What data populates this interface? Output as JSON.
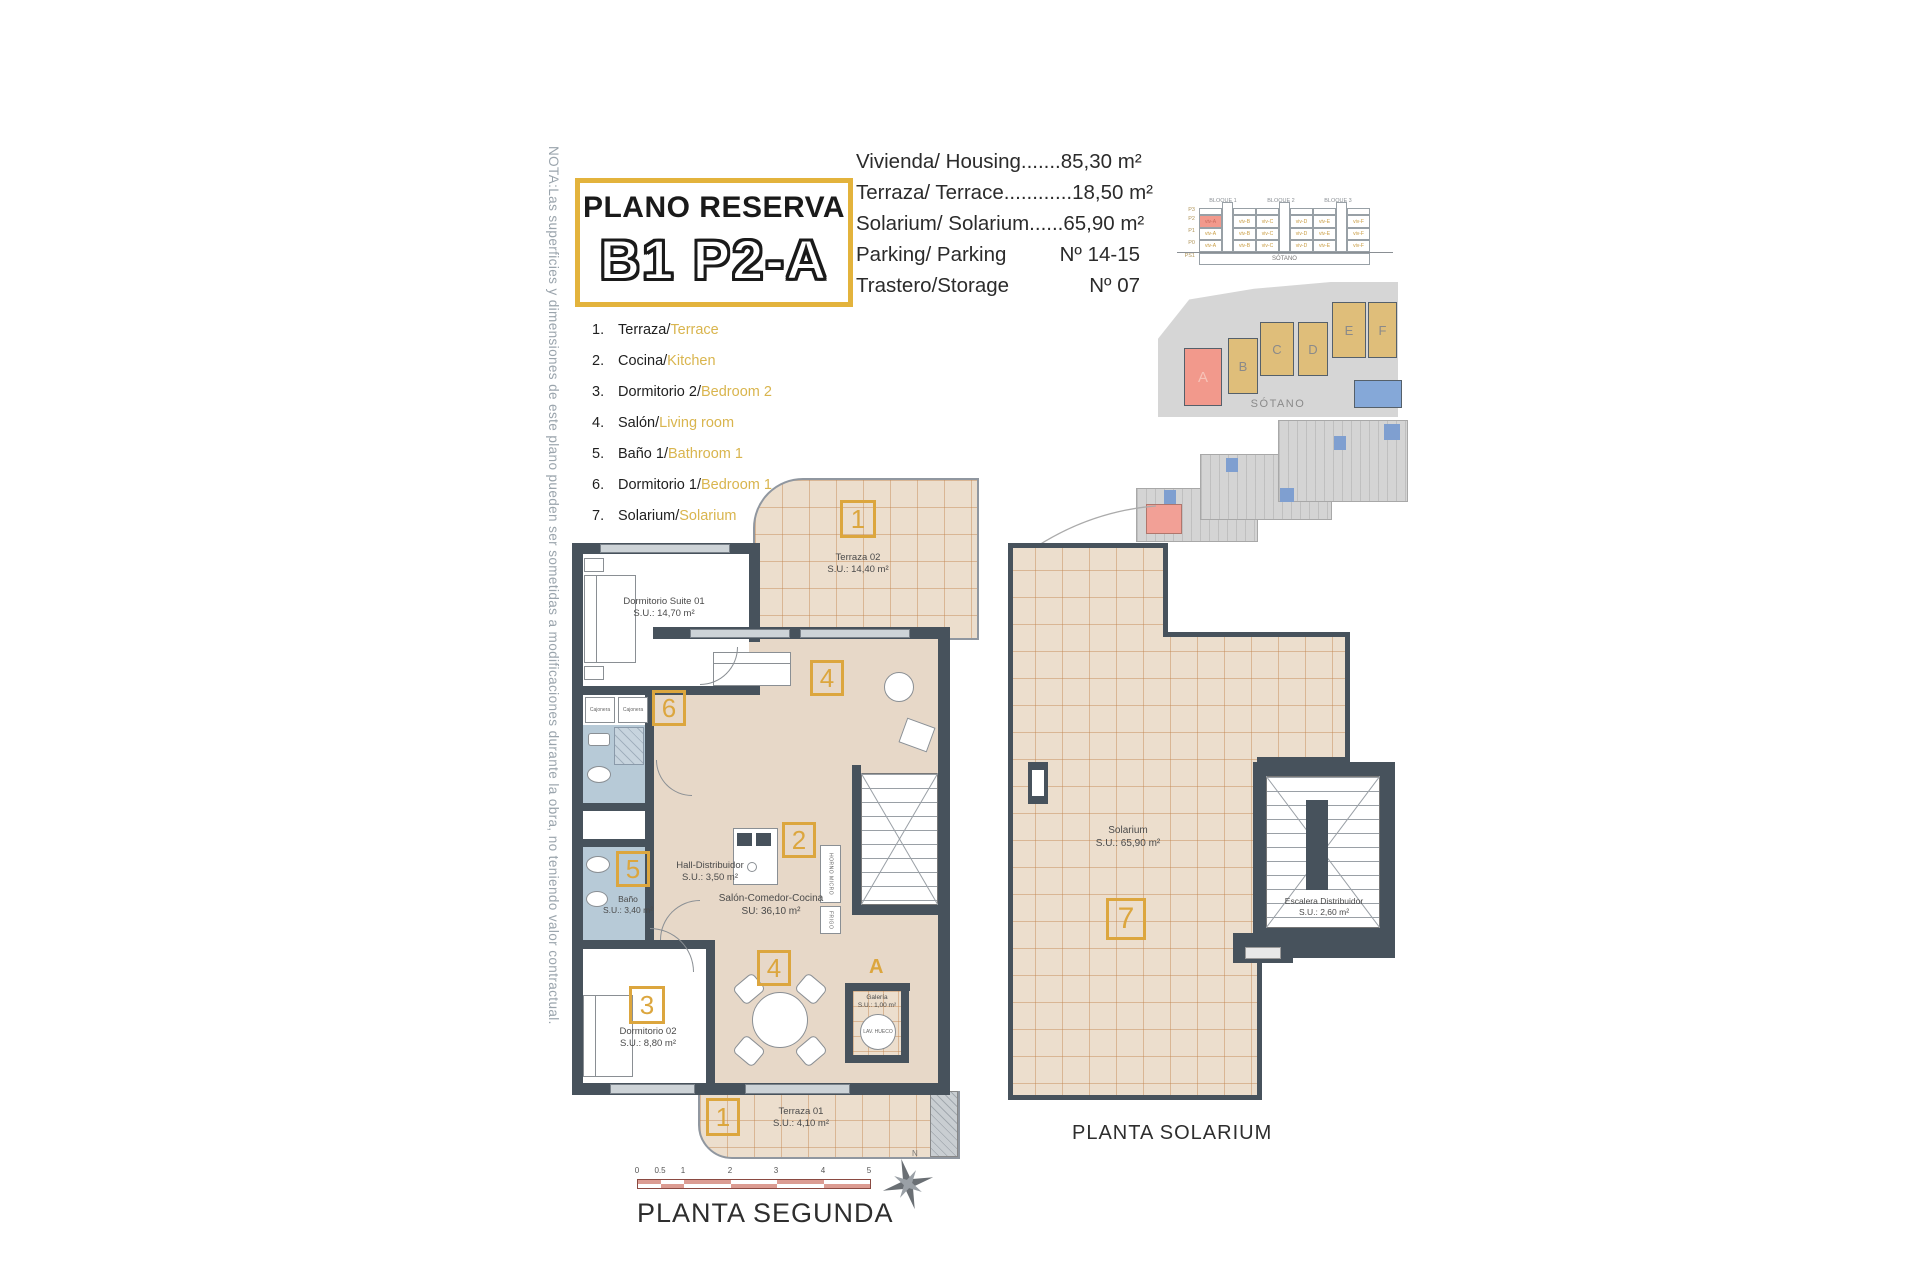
{
  "colors": {
    "accent_yellow": "#E3B33C",
    "badge_yellow": "#DCA63E",
    "legend_yellow": "#D9B54E",
    "wall_dark": "#47525C",
    "floor_tan": "#E7D8C8",
    "bath_blue": "#B7CAD7",
    "tile_line": "#C1864F",
    "highlight_red": "#F2998C",
    "block_tan": "#DFBE7A",
    "pool_blue": "#85A8D8"
  },
  "note": "NOTA:Las superficies y dimensiones de este plano pueden ser sometidas a modificaciones durante la obra, no teniendo valor contractual.",
  "title": {
    "subtitle": "PLANO RESERVA",
    "code": "B1 P2-A"
  },
  "summary": [
    {
      "label": "Vivienda/ Housing",
      "dots": ".......",
      "value": "85,30 m²"
    },
    {
      "label": "Terraza/ Terrace",
      "dots": "............",
      "value": "18,50 m²"
    },
    {
      "label": "Solarium/ Solarium",
      "dots": "......",
      "value": "65,90 m²"
    },
    {
      "label": "Parking/ Parking",
      "dots": "",
      "value": "Nº 14-15"
    },
    {
      "label": "Trastero/Storage",
      "dots": "",
      "value": "Nº 07"
    }
  ],
  "legend": [
    {
      "num": "1.",
      "es": "Terraza",
      "sep": " / ",
      "en": "Terrace"
    },
    {
      "num": "2.",
      "es": "Cocina",
      "sep": " / ",
      "en": "Kitchen"
    },
    {
      "num": "3.",
      "es": "Dormitorio 2",
      "sep": " / ",
      "en": "Bedroom 2"
    },
    {
      "num": "4.",
      "es": "Salón",
      "sep": " / ",
      "en": "Living room"
    },
    {
      "num": "5.",
      "es": "Baño 1",
      "sep": " / ",
      "en": "Bathroom 1"
    },
    {
      "num": "6.",
      "es": "Dormitorio 1",
      "sep": " /",
      "en": "Bedroom 1"
    },
    {
      "num": "7.",
      "es": "Solarium",
      "sep": "/",
      "en": "Solarium"
    }
  ],
  "elevation": {
    "blocks": [
      "BLOQUE 1",
      "BLOQUE 2",
      "BLOQUE 3"
    ],
    "floors": [
      "P3",
      "P2",
      "P1",
      "P0",
      "PS1"
    ],
    "units": [
      "viv-A",
      "viv-B",
      "viv-C",
      "viv-D",
      "viv-E",
      "viv-F"
    ],
    "basement": "SÓTANO"
  },
  "siteplan": {
    "labels": [
      "A",
      "B",
      "C",
      "D",
      "E",
      "F"
    ]
  },
  "sotano": {
    "label": "SÓTANO"
  },
  "plan2": {
    "title": "PLANTA SEGUNDA",
    "north": "N",
    "scale_ticks": [
      "0",
      "0.5",
      "1",
      "2",
      "3",
      "4",
      "5"
    ],
    "badges": {
      "terraza02": "1",
      "cocina": "2",
      "dorm02": "3",
      "salon_a": "4",
      "salon_b": "4",
      "bano": "5",
      "dorm01": "6",
      "terraza01": "1",
      "galeria_mark": "A"
    },
    "rooms": {
      "suite": {
        "name": "Dormitorio Suite 01",
        "area": "S.U.: 14,70 m²"
      },
      "terraza02": {
        "name": "Terraza 02",
        "area": "S.U.: 14,40 m²"
      },
      "hall": {
        "name": "Hall-Distribuidor",
        "area": "S.U.: 3,50 m²"
      },
      "bano": {
        "name": "Baño",
        "area": "S.U.: 3,40 m²"
      },
      "salon": {
        "name": "Salón-Comedor-Cocina",
        "area": "SU: 36,10 m²"
      },
      "dorm02": {
        "name": "Dormitorio 02",
        "area": "S.U.: 8,80 m²"
      },
      "galeria": {
        "name": "Galería",
        "area": "S.U.: 1,00 m²"
      },
      "terraza01": {
        "name": "Terraza 01",
        "area": "S.U.: 4,10 m²"
      }
    },
    "fixtures": {
      "closet1": "Cajonera",
      "closet2": "Cajonera",
      "lav": "LAV. HUECO",
      "horno": "HORNO MICRO",
      "frigo": "FRIGO"
    }
  },
  "solarium_plan": {
    "title": "PLANTA SOLARIUM",
    "badge": "7",
    "rooms": {
      "solarium": {
        "name": "Solarium",
        "area": "S.U.: 65,90 m²"
      },
      "escalera": {
        "name": "Escalera Distribuidor",
        "area": "S.U.: 2,60 m²"
      }
    }
  }
}
